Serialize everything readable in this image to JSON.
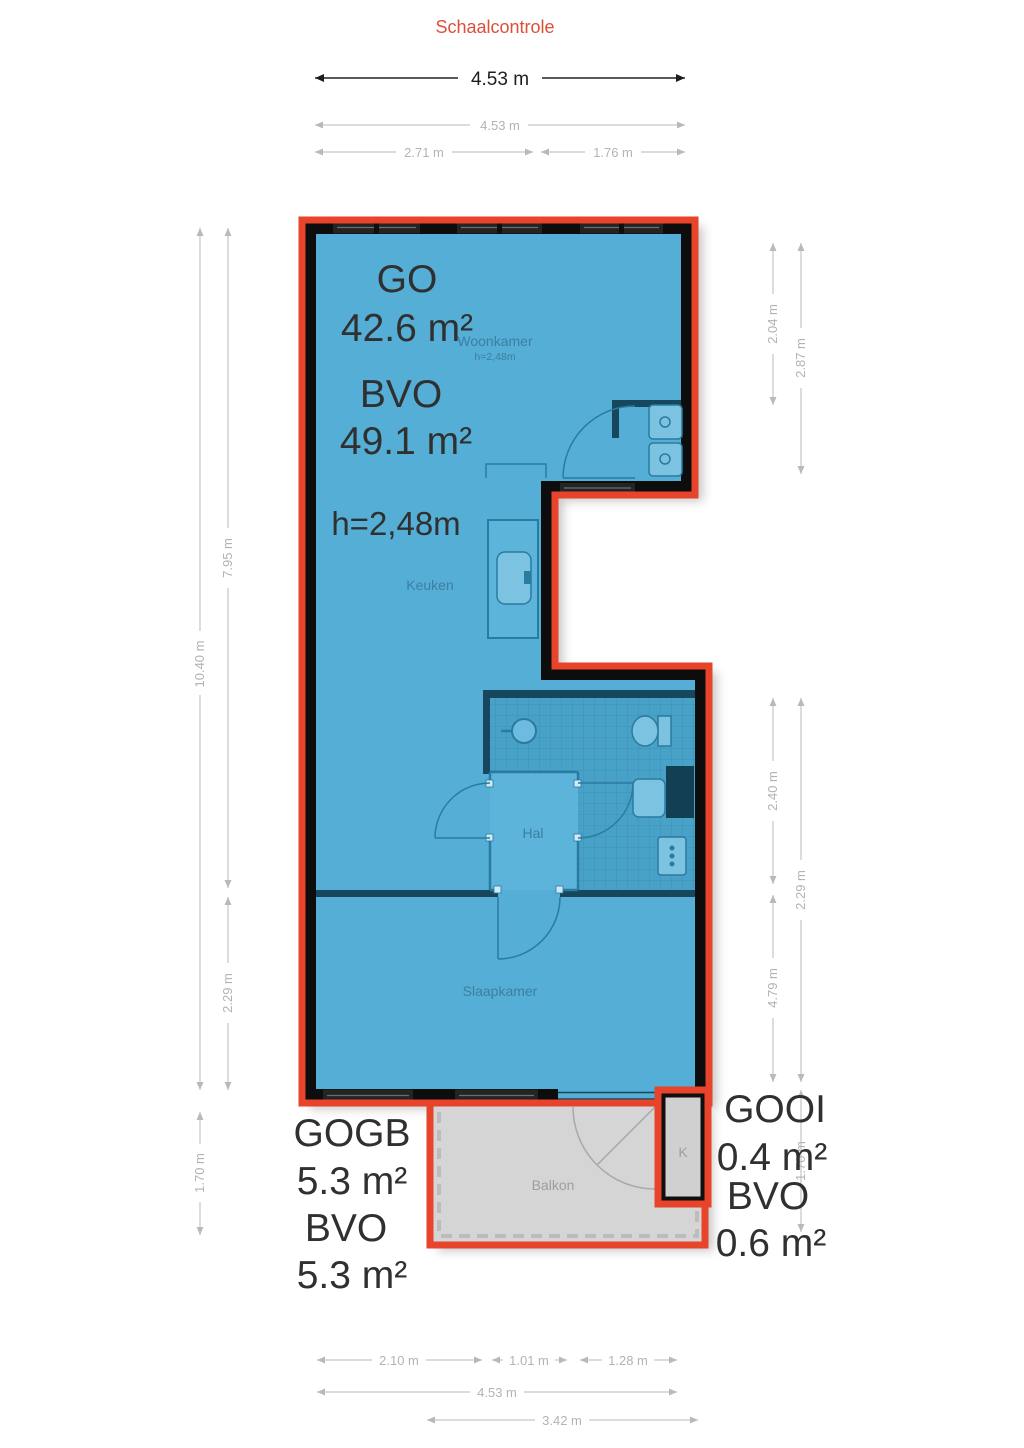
{
  "title": "Schaalcontrole",
  "scale_check": {
    "total_width_label": "4.53 m"
  },
  "plan": {
    "area_summary": {
      "go_label": "GO",
      "go_value": "42.6 m²",
      "bvo_label": "BVO",
      "bvo_value": "49.1 m²",
      "ceiling_height": "h=2,48m"
    },
    "rooms": {
      "woonkamer": {
        "name": "Woonkamer",
        "ceiling_height": "h=2,48m"
      },
      "keuken": {
        "name": "Keuken"
      },
      "hal": {
        "name": "Hal"
      },
      "slaapkamer": {
        "name": "Slaapkamer"
      },
      "balkon": {
        "name": "Balkon"
      },
      "kast": {
        "name": "K"
      }
    },
    "balcony_summary": {
      "label": "GOGB",
      "value": "5.3 m²",
      "bvo_label": "BVO",
      "bvo_value": "5.3 m²"
    },
    "storage_summary": {
      "label": "GOOI",
      "value": "0.4 m²",
      "bvo_label": "BVO",
      "bvo_value": "0.6 m²"
    }
  },
  "dimensions": {
    "top": [
      {
        "label": "4.53 m"
      },
      {
        "label": "2.71 m"
      },
      {
        "label": "1.76 m"
      }
    ],
    "left": [
      {
        "label": "10.40 m"
      },
      {
        "label": "7.95 m"
      },
      {
        "label": "2.29 m"
      },
      {
        "label": "1.70 m"
      }
    ],
    "right": [
      {
        "label": "2.04 m"
      },
      {
        "label": "2.87 m"
      },
      {
        "label": "2.40 m"
      },
      {
        "label": "4.79 m"
      },
      {
        "label": "2.29 m"
      },
      {
        "label": "1.70 m"
      }
    ],
    "bottom": [
      {
        "label": "2.10 m"
      },
      {
        "label": "1.01 m"
      },
      {
        "label": "1.28 m"
      },
      {
        "label": "4.53 m"
      },
      {
        "label": "3.42 m"
      }
    ]
  },
  "colors": {
    "accent_red": "#e8432b",
    "floor_blue": "#55aed6",
    "tile_blue": "#48a1c7",
    "wall_black": "#0f0f0f",
    "partition_blue": "#17475d",
    "balcony_gray": "#d5d5d5",
    "dimension_gray": "#b3b3b3",
    "text_dark": "#303030",
    "room_label_blue": "#3c7fa2",
    "title_red": "#de4f3a"
  }
}
